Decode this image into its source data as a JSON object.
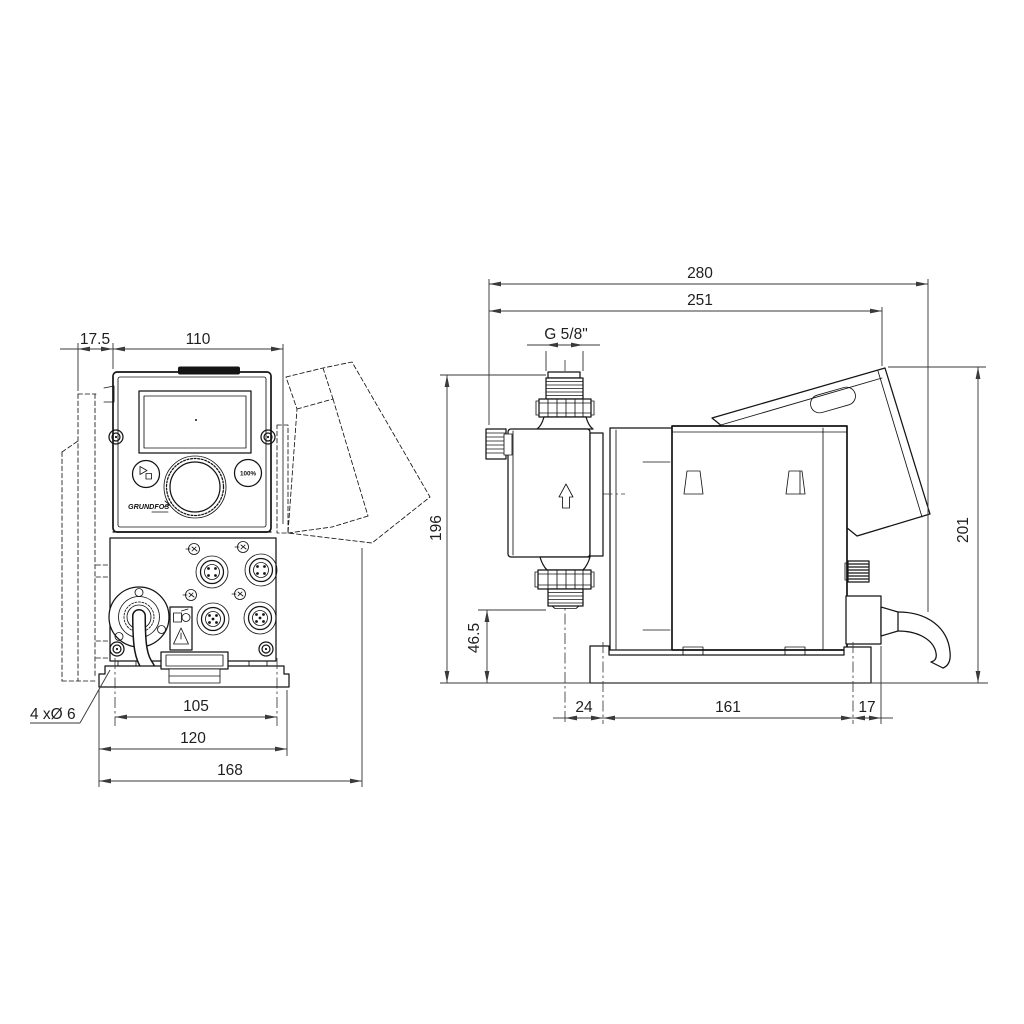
{
  "front_view": {
    "dim_wall_offset": "17.5",
    "dim_width_top": "110",
    "dim_hole_spacing": "105",
    "dim_plate_width": "120",
    "dim_total_width": "168",
    "holes_note": "4 xØ 6",
    "brand": "GRUNDFOS",
    "button_100": "100%"
  },
  "side_view": {
    "dim_total_length": "280",
    "dim_length_to_hood": "251",
    "thread_size": "G 5/8\"",
    "dim_height_valve": "196",
    "dim_valve_clearance": "46.5",
    "dim_total_height": "201",
    "dim_base_offset": "24",
    "dim_hole_spacing": "161",
    "dim_rear_offset": "17"
  }
}
